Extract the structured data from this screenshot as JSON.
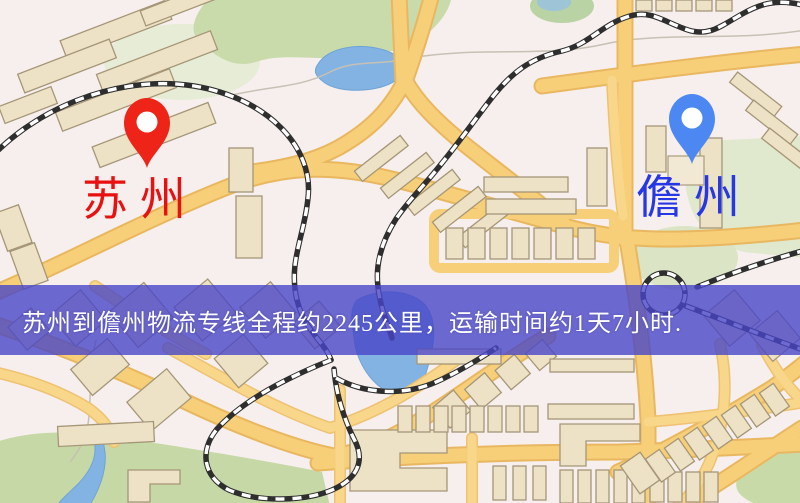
{
  "banner": {
    "text": "苏州到儋州物流专线全程约2245公里，运输时间约1天7小时.",
    "background_color": "#4846c7",
    "background_opacity": 0.8,
    "text_color": "#ffffff"
  },
  "markers": {
    "origin": {
      "label": "苏州",
      "pin_icon": "map-pin",
      "pin_color": "#ee2418",
      "label_color": "#e81010"
    },
    "destination": {
      "label": "儋州",
      "pin_icon": "map-pin",
      "pin_color": "#4d88f2",
      "label_color": "#2638e6"
    }
  },
  "map_colors": {
    "background": "#f6efed",
    "road_fill": "#f6cf78",
    "road_casing": "#e9b760",
    "park_green": "#cadbab",
    "pale_green": "#e0e8cd",
    "water_blue": "#82b3e3",
    "building_fill": "#ede2c6",
    "building_outline": "#a69678",
    "railway_dark": "#2e2e2e",
    "railway_light": "#ffffff"
  }
}
